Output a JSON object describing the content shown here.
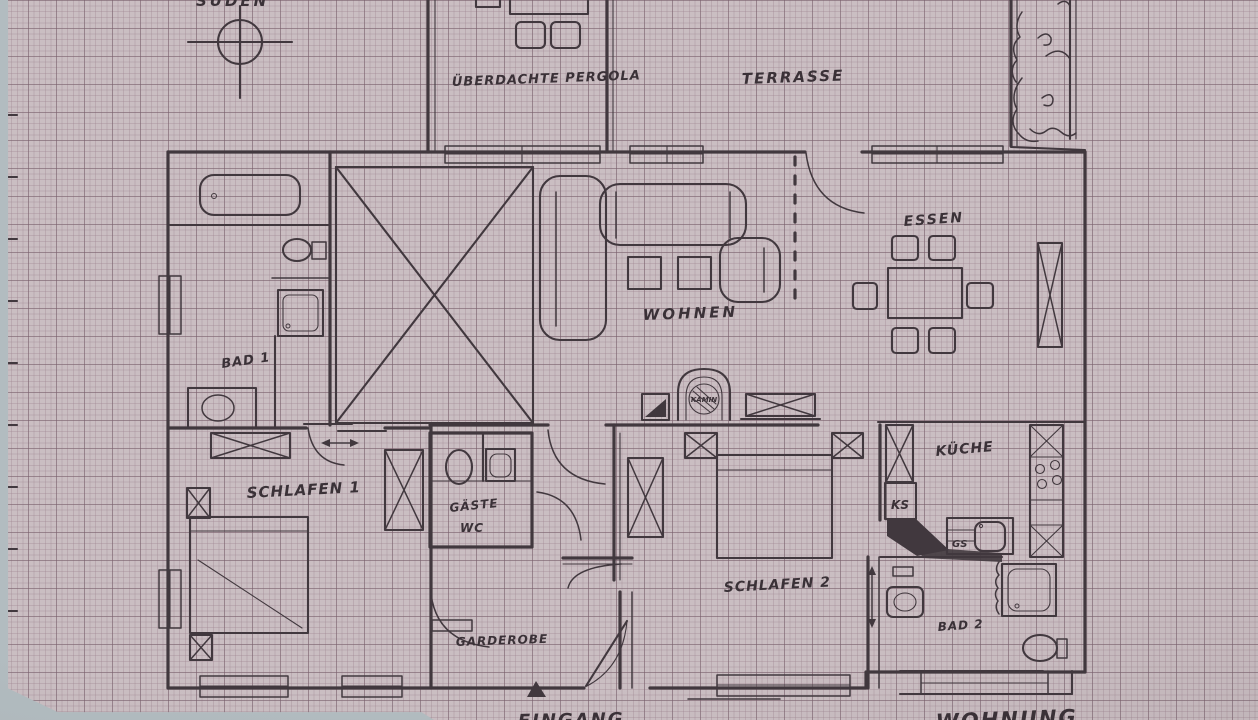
{
  "meta": {
    "type": "hand-drawn apartment floor plan photographed on graph paper"
  },
  "labels": {
    "sueden": "SÜDEN",
    "pergola": "ÜBERDACHTE PERGOLA",
    "terrasse": "TERRASSE",
    "essen": "ESSEN",
    "wohnen": "WOHNEN",
    "kamin": "KAMIN",
    "bad1": "BAD 1",
    "schlafen1": "SCHLAFEN 1",
    "gaeste": "GÄSTE",
    "wc": "WC",
    "kueche": "KÜCHE",
    "ks": "KS",
    "gs": "GS",
    "schlafen2": "SCHLAFEN 2",
    "bad2": "BAD 2",
    "garderobe": "GARDEROBE",
    "eingang": "EINGANG",
    "wohnung": "WOHNUNG"
  },
  "colors": {
    "paper": "#cabec2",
    "grid_minor": "#b5a6ad",
    "grid_major": "#9d8c95",
    "ink": "#41383e",
    "photo_background": "#b2bcc0"
  }
}
